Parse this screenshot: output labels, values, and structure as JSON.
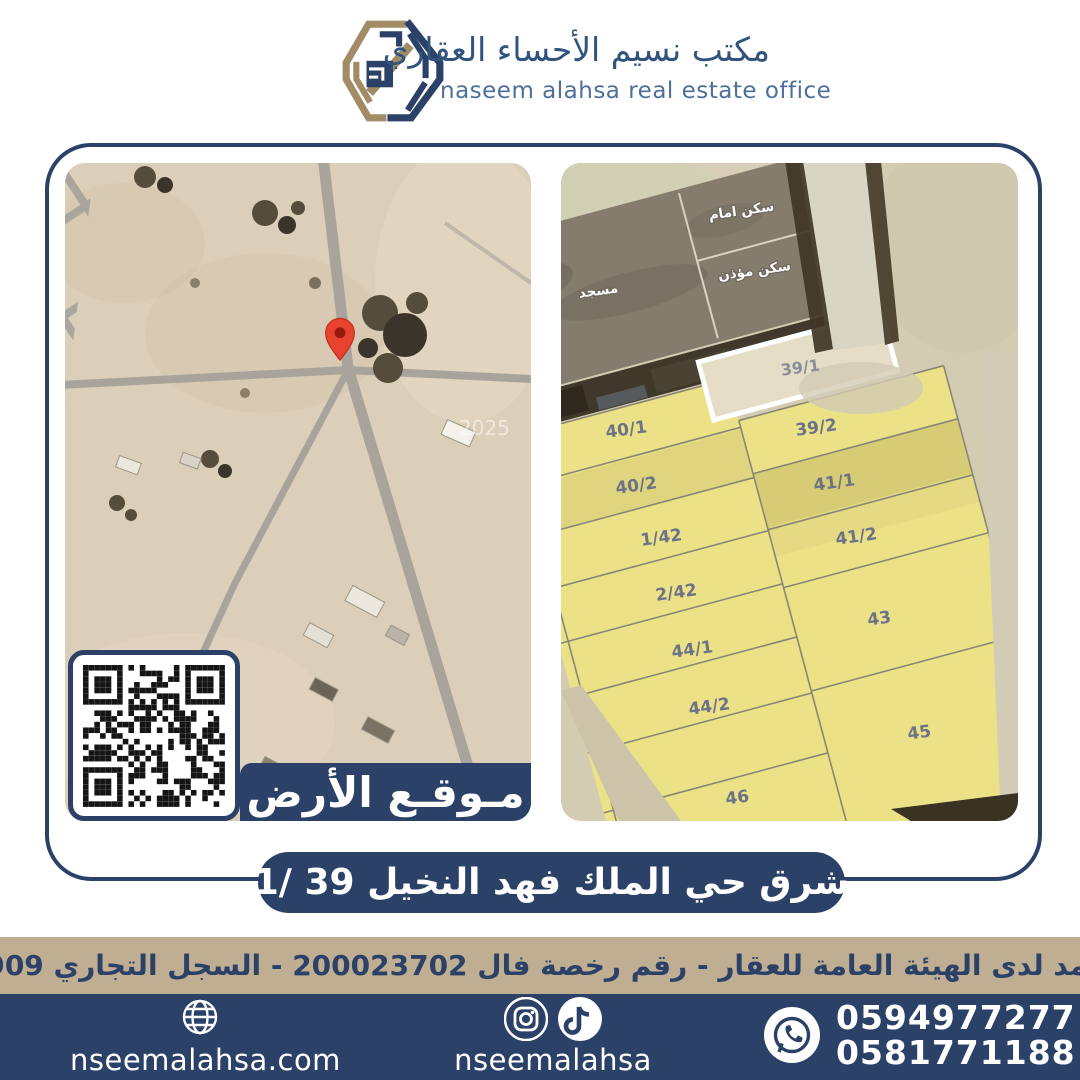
{
  "header": {
    "brand_name_ar": "مكتب نسيم الأحساء العقاري",
    "brand_name_en": "naseem alahsa real estate office"
  },
  "left_map": {
    "banner_label": "مـوقـع الأرض",
    "watermark": "2025",
    "pin_icon": "red-location-pin"
  },
  "right_map": {
    "zone_labels": [
      {
        "label": "سكن امام"
      },
      {
        "label": "سكن مؤذن"
      },
      {
        "label": "مسجد"
      }
    ],
    "highlight_parcel": {
      "label": "39/1"
    },
    "parcels": [
      {
        "label": "40/1"
      },
      {
        "label": "40/2"
      },
      {
        "label": "1/42"
      },
      {
        "label": "2/42"
      },
      {
        "label": "44/1"
      },
      {
        "label": "44/2"
      },
      {
        "label": "46"
      },
      {
        "label": "39/2"
      },
      {
        "label": "41/1"
      },
      {
        "label": "41/2"
      },
      {
        "label": "43"
      },
      {
        "label": "45"
      }
    ]
  },
  "location_banner": {
    "text": "شرق حي الملك فهد النخيل  39 /1"
  },
  "license_bar": {
    "text": "مسوق معتمد لدى الهيئة العامة للعقار  - رقم رخصة فال 200023702 - السجل التجاري 2250373909"
  },
  "footer": {
    "website": "nseemalahsa.com",
    "social_handle": "nseemalahsa",
    "phone_1": "0594977277",
    "phone_2": "0581771188",
    "icons": [
      "globe-icon",
      "instagram-icon",
      "tiktok-icon",
      "whatsapp-icon"
    ]
  },
  "colors": {
    "navy": "#2b4168",
    "tan_bar": "#c0ae92",
    "logo_tan": "#a28c66",
    "brand_blue": "#30547d",
    "parcel_yellow": "#ebe288",
    "pin_red": "#e8432e"
  }
}
